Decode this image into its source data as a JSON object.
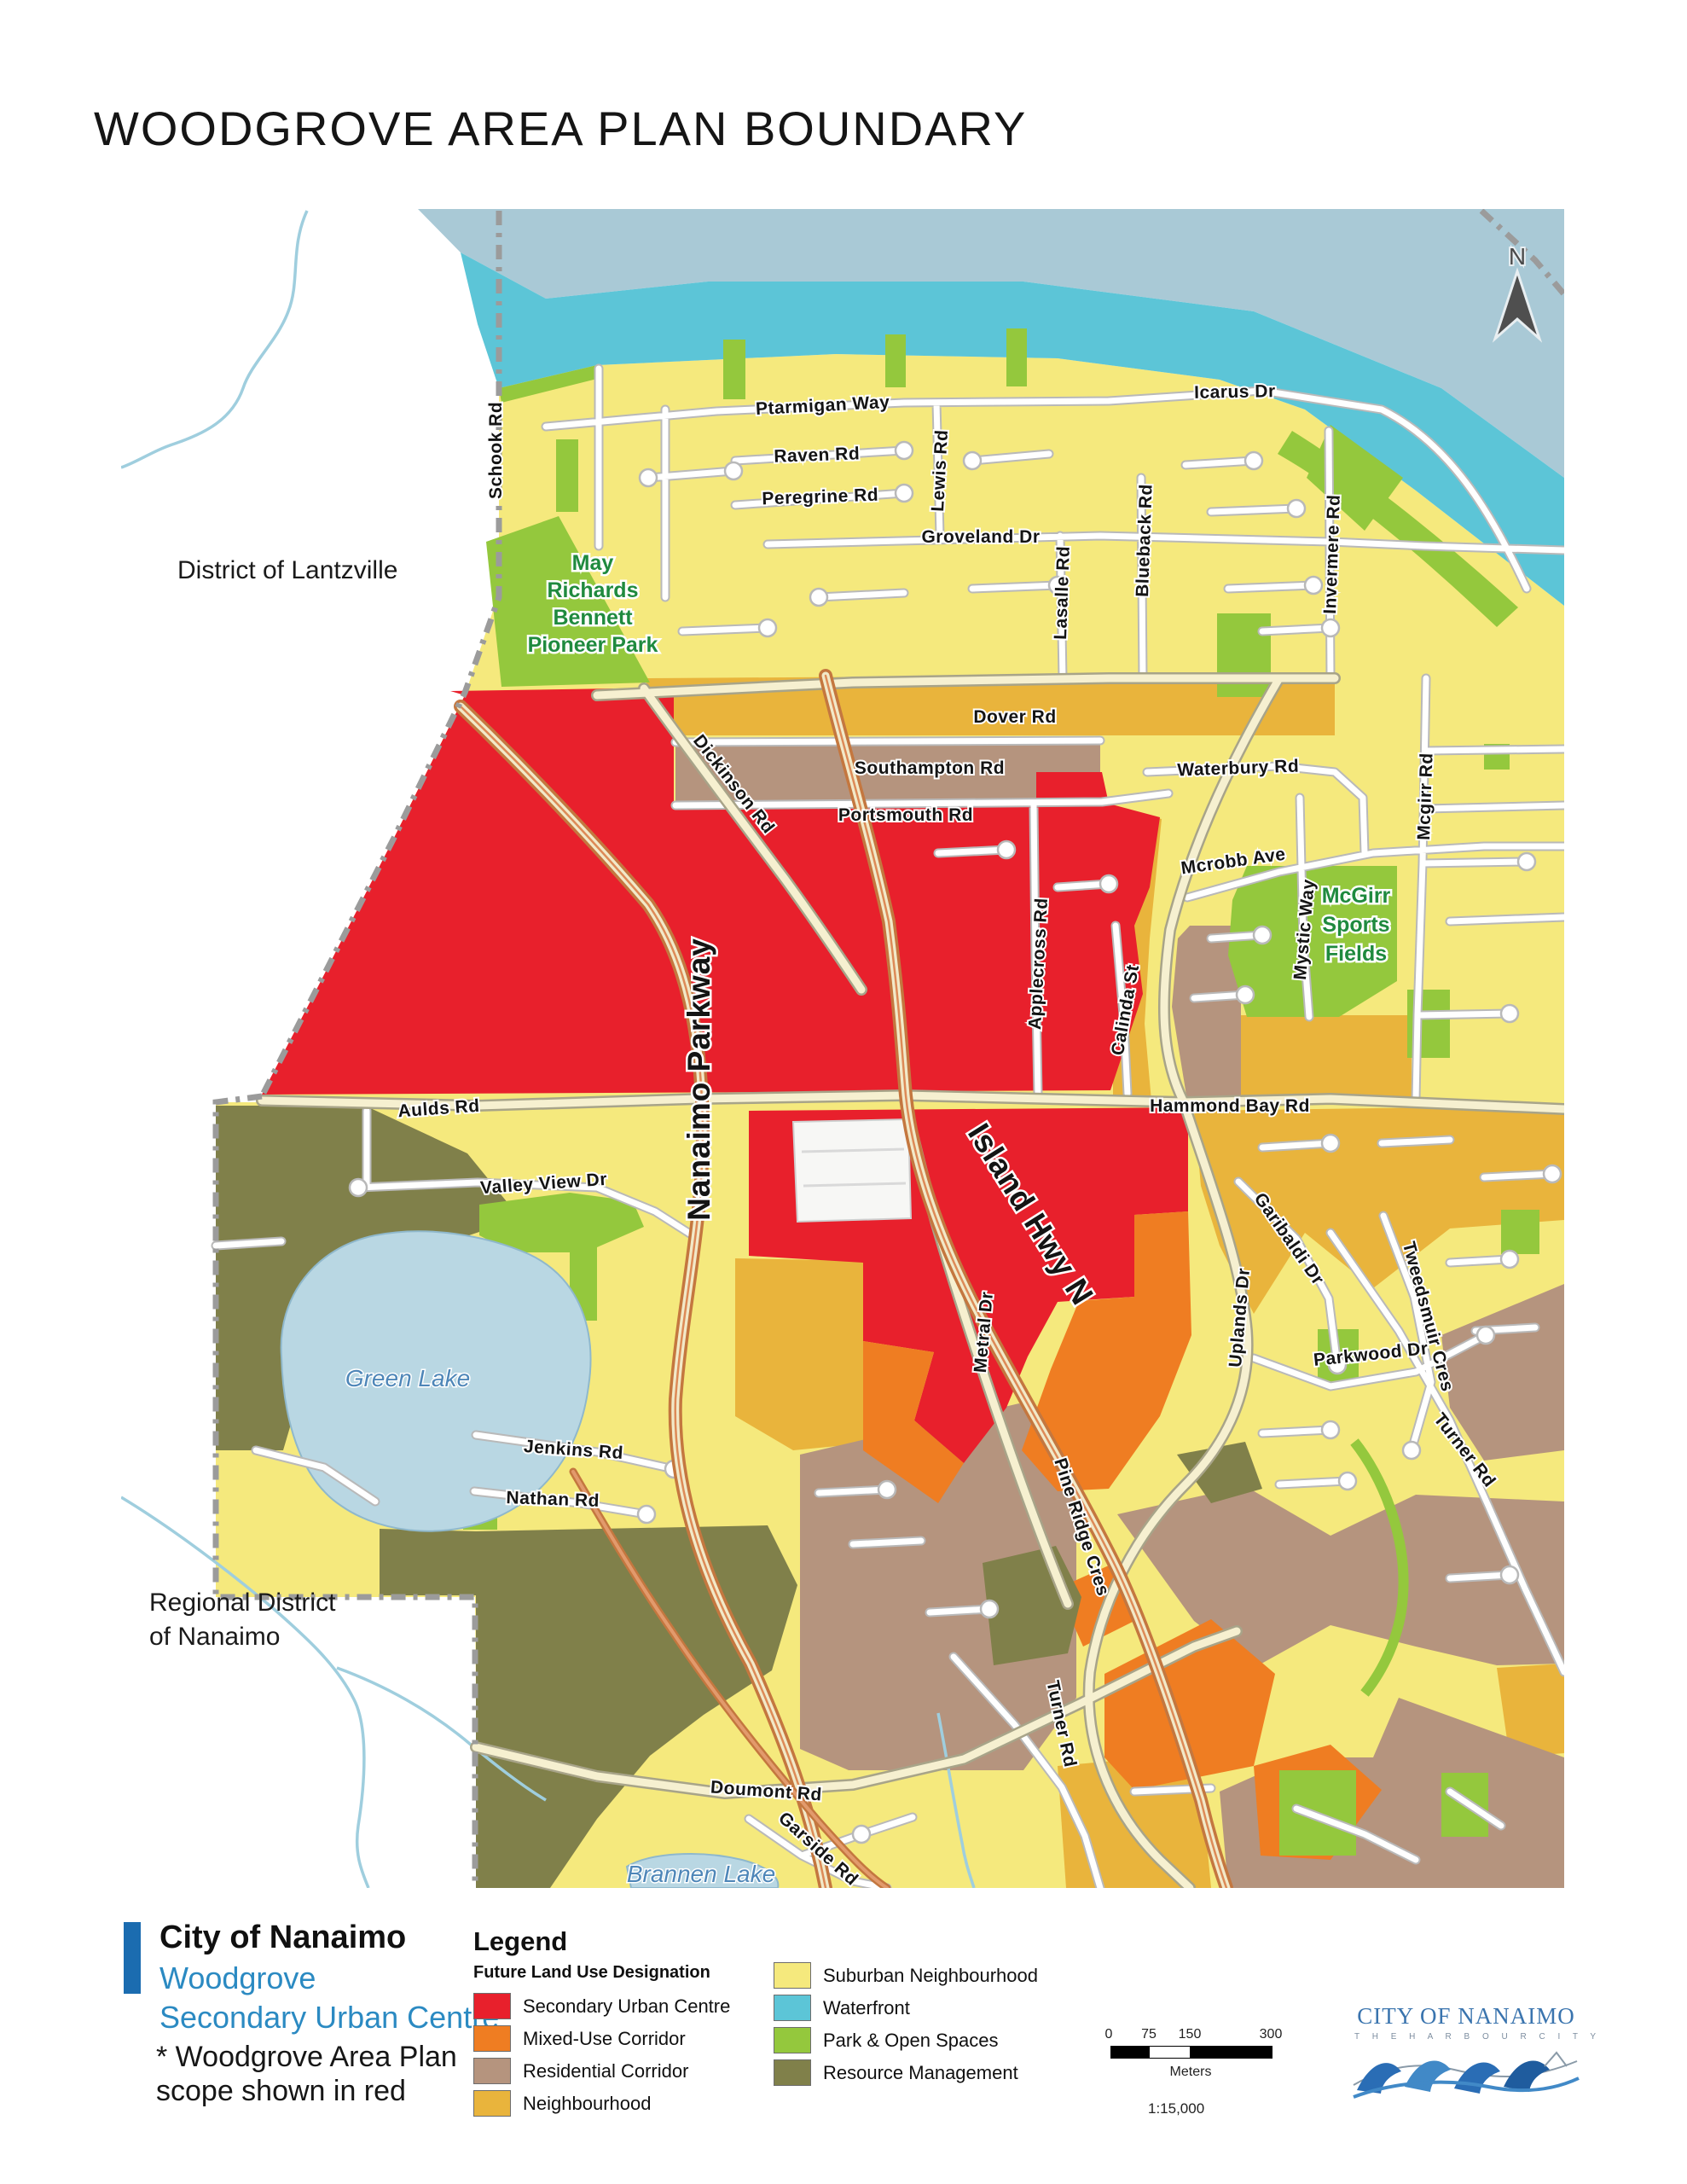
{
  "title": "WOODGROVE AREA PLAN BOUNDARY",
  "map": {
    "north_label": "N",
    "regions": {
      "lantzville": "District of Lantzville",
      "rdn_line1": "Regional District",
      "rdn_line2": "of Nanaimo"
    },
    "parks": {
      "may": {
        "l1": "May",
        "l2": "Richards",
        "l3": "Bennett",
        "l4": "Pioneer Park"
      },
      "mcgirr": {
        "l1": "McGirr",
        "l2": "Sports",
        "l3": "Fields"
      }
    },
    "lakes": {
      "green": "Green Lake",
      "brannen": "Brannen Lake"
    },
    "roads": {
      "schook": "Schook Rd",
      "ptarmigan": "Ptarmigan Way",
      "raven": "Raven Rd",
      "peregrine": "Peregrine Rd",
      "groveland": "Groveland Dr",
      "lewis": "Lewis Rd",
      "lasalle": "Lasalle Rd",
      "blueback": "Blueback Rd",
      "icarus": "Icarus Dr",
      "invermere": "Invermere Rd",
      "mcgirr_rd": "Mcgirr Rd",
      "dover": "Dover Rd",
      "southampton": "Southampton Rd",
      "portsmouth": "Portsmouth Rd",
      "waterbury": "Waterbury Rd",
      "mcrobb": "Mcrobb Ave",
      "mystic": "Mystic Way",
      "dickinson": "Dickinson Rd",
      "applecross": "Applecross Rd",
      "calinda": "Calinda St",
      "hammond": "Hammond Bay Rd",
      "aulds": "Aulds Rd",
      "valleyview": "Valley View Dr",
      "nanaimo_pkwy": "Nanaimo Parkway",
      "island_hwy": "Island Hwy N",
      "metral": "Metral Dr",
      "uplands": "Uplands Dr",
      "garibaldi": "Garibaldi Dr",
      "parkwood": "Parkwood Dr",
      "tweedsmuir": "Tweedsmuir Cres",
      "turner_ne": "Turner Rd",
      "turner_sw": "Turner Rd",
      "pineridge": "Pine Ridge Cres",
      "jenkins": "Jenkins Rd",
      "nathan": "Nathan Rd",
      "doumont": "Doumont Rd",
      "garside": "Garside Rd"
    }
  },
  "footer": {
    "brand_title": "City of Nanaimo",
    "brand_sub1": "Woodgrove",
    "brand_sub2": "Secondary Urban Centre",
    "note_line1": "* Woodgrove Area Plan",
    "note_line2": "scope shown in red",
    "accent_color": "#1b6cb0"
  },
  "legend": {
    "heading": "Legend",
    "subheading": "Future Land Use Designation",
    "items": [
      {
        "label": "Secondary Urban Centre",
        "color": "#e8202c"
      },
      {
        "label": "Mixed-Use Corridor",
        "color": "#ef7d22"
      },
      {
        "label": "Residential Corridor",
        "color": "#b5947e"
      },
      {
        "label": "Neighbourhood",
        "color": "#e9b43c"
      },
      {
        "label": "Suburban Neighbourhood",
        "color": "#f5e97d"
      },
      {
        "label": "Waterfront",
        "color": "#5cc5d7"
      },
      {
        "label": "Park & Open Spaces",
        "color": "#94c83d"
      },
      {
        "label": "Resource Management",
        "color": "#80804a"
      }
    ]
  },
  "scale_bar": {
    "t0": "0",
    "t1": "75",
    "t2": "150",
    "t3": "300",
    "units": "Meters",
    "ratio": "1:15,000"
  },
  "logo": {
    "name": "CITY OF NANAIMO",
    "tagline": "T H E   H A R B O U R   C I T Y"
  }
}
